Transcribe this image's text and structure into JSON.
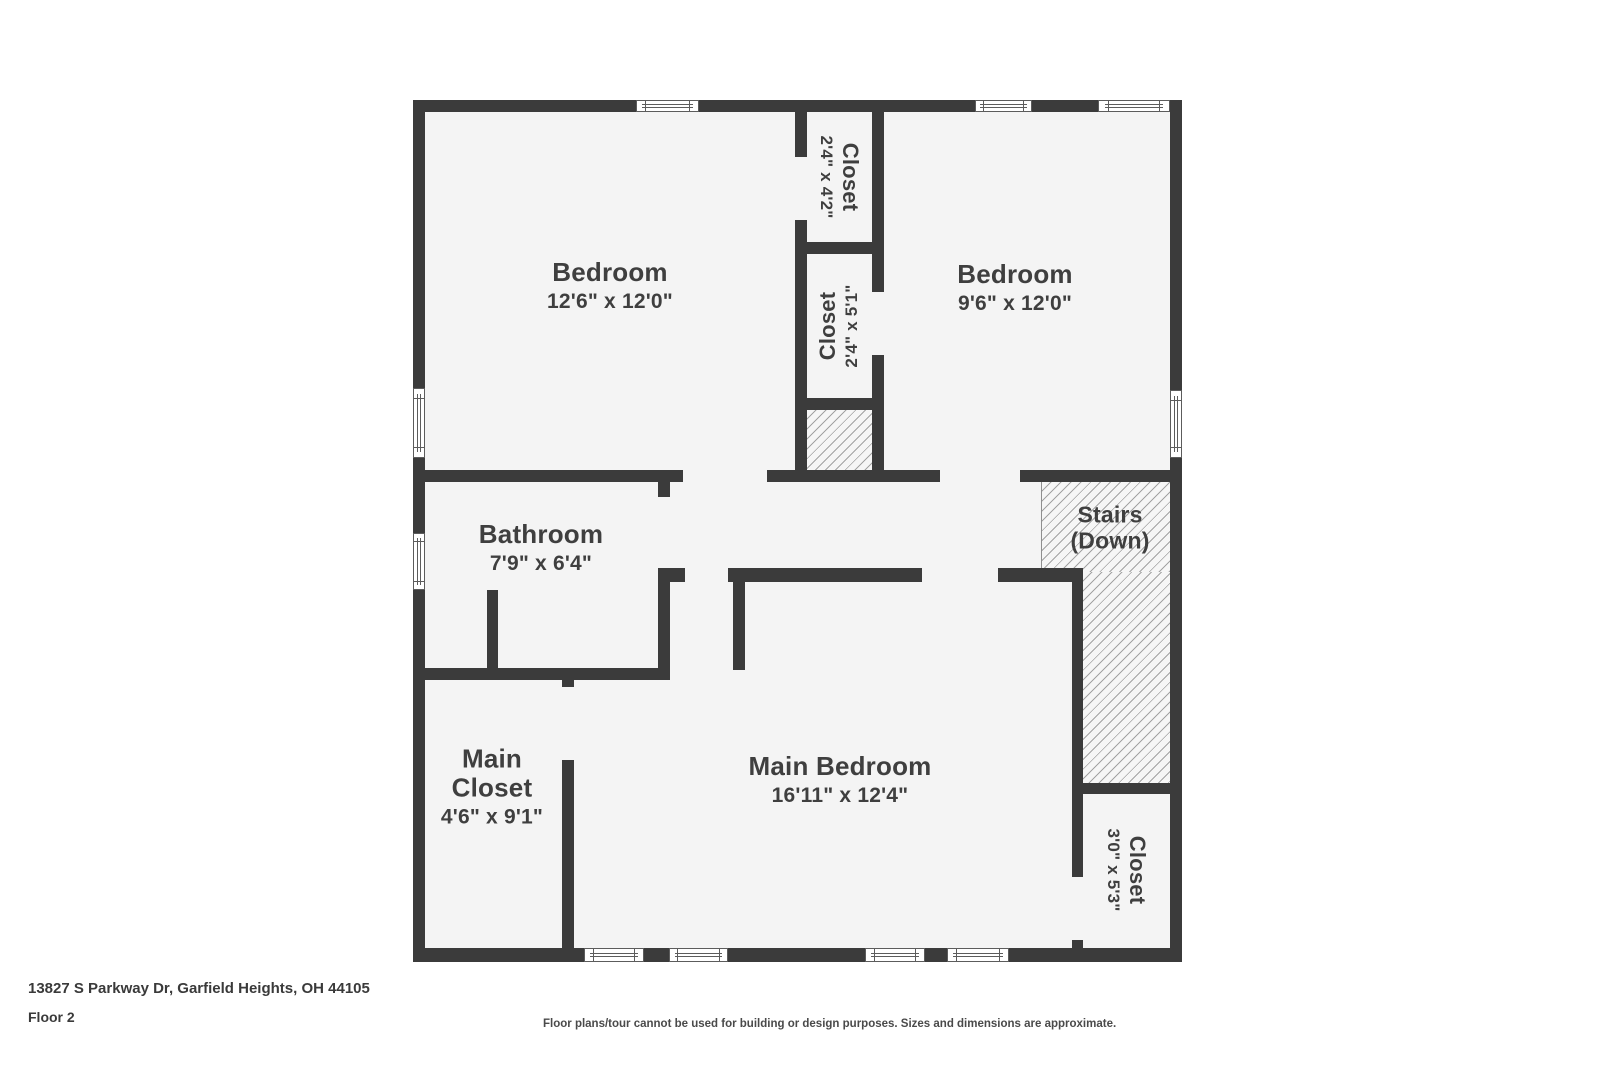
{
  "rooms": {
    "bedroom1": {
      "label": "Bedroom",
      "dims": "12'6\" x 12'0\""
    },
    "bedroom2": {
      "label": "Bedroom",
      "dims": "9'6\" x 12'0\""
    },
    "bathroom": {
      "label": "Bathroom",
      "dims": "7'9\" x 6'4\""
    },
    "main_bedroom": {
      "label": "Main Bedroom",
      "dims": "16'11\" x 12'4\""
    },
    "main_closet": {
      "label": "Main Closet",
      "dims": "4'6\" x 9'1\""
    },
    "closet_top": {
      "label": "Closet",
      "dims": "2'4\" x 4'2\""
    },
    "closet_mid": {
      "label": "Closet",
      "dims": "2'4\" x 5'1\""
    },
    "closet_br": {
      "label": "Closet",
      "dims": "3'0\" x 5'3\""
    },
    "stairs": {
      "label": "Stairs",
      "sublabel": "(Down)"
    }
  },
  "footer": {
    "address": "13827 S Parkway Dr, Garfield Heights, OH 44105",
    "floor_label": "Floor 2",
    "disclaimer": "Floor plans/tour cannot be used for building or design purposes. Sizes and dimensions are approximate."
  },
  "colors": {
    "wall": "#3b3b3b",
    "floor": "#f4f4f4",
    "hatch_line": "#a3a3a3",
    "text": "#3f3f3f"
  }
}
